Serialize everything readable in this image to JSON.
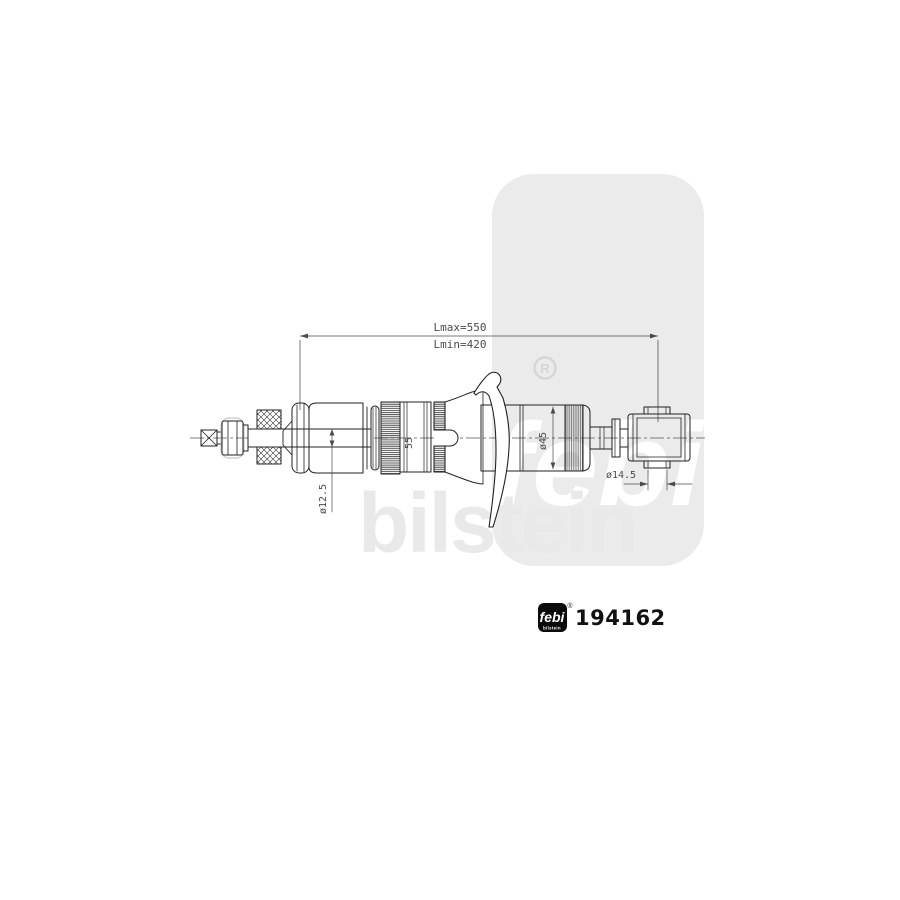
{
  "diagram": {
    "title": "shock absorber technical drawing",
    "dimensions": {
      "lmax": "Lmax=550",
      "lmin": "Lmin=420",
      "rod_diameter": "ø12.5",
      "seat_width": "55",
      "body_diameter": "ø45",
      "bushing_diameter": "ø14.5"
    },
    "watermark": {
      "brand": "febi",
      "sub_brand": "bilstein",
      "registered": "R"
    },
    "part_label": {
      "brand": "febi",
      "brand_sub": "bilstein",
      "registered": "®",
      "part_number": "194162"
    },
    "colors": {
      "line": "#222222",
      "dimension": "#4a4a4a",
      "watermark_box": "#ebebeb",
      "watermark_text": "#e9e9e9",
      "logo_background": "#0a0a0a"
    }
  }
}
